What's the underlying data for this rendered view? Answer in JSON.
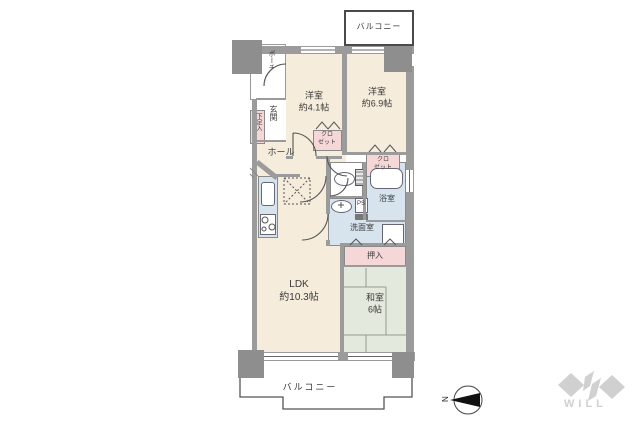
{
  "floor_plan": {
    "balconies": {
      "top": "バルコニー",
      "bottom": "バルコニー"
    },
    "entrance": {
      "porch": "ポーチ",
      "genkan": "玄関",
      "shoe_cabinet": "下足入",
      "hall": "ホール"
    },
    "rooms": {
      "western1": {
        "name": "洋室",
        "size": "約4.1帖"
      },
      "western2": {
        "name": "洋室",
        "size": "約6.9帖"
      },
      "ldk": {
        "name": "LDK",
        "size": "約10.3帖"
      },
      "japanese": {
        "name": "和室",
        "size": "6帖"
      }
    },
    "water": {
      "bath": "浴室",
      "washroom": "洗面室",
      "pipe_space": "PS"
    },
    "storage": {
      "closet_line1": "クロ",
      "closet_line2": "ゼット",
      "oshiire": "押入"
    },
    "compass": {
      "north": "N"
    },
    "branding": {
      "logo": "WILL"
    }
  },
  "colors": {
    "room_cream": "#f6ecdb",
    "closet_pink": "#f6d7d7",
    "water_blue": "#d7e4ee",
    "tatami_green": "#e3e9dc",
    "wall_gray": "#9b9b9b",
    "pillar_gray": "#8e8e8e",
    "line_dark": "#555555",
    "label_color": "#3a3a3a",
    "logo_gray": "#d0d0d0"
  }
}
